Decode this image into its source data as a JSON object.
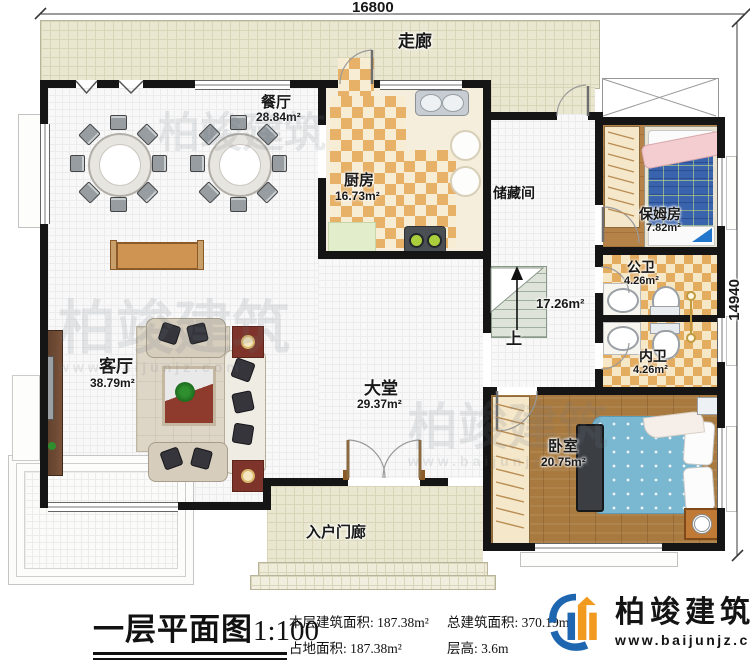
{
  "dimensions": {
    "top": "16800",
    "right": "14940"
  },
  "rooms": {
    "corridor": {
      "name": "走廊"
    },
    "dining": {
      "name": "餐厅",
      "area": "28.84m²"
    },
    "kitchen": {
      "name": "厨房",
      "area": "16.73m²"
    },
    "storage": {
      "name": "储藏间"
    },
    "nanny": {
      "name": "保姆房",
      "area": "7.82m²"
    },
    "public_bath": {
      "name": "公卫",
      "area": "4.26m²"
    },
    "private_bath": {
      "name": "内卫",
      "area": "4.26m²"
    },
    "living": {
      "name": "客厅",
      "area": "38.79m²"
    },
    "hall": {
      "name": "大堂",
      "area": "29.37m²"
    },
    "bedroom": {
      "name": "卧室",
      "area": "20.75m²"
    },
    "porch": {
      "name": "入户门廊"
    },
    "stairwell": {
      "area": "17.26m²",
      "up": "上"
    }
  },
  "title": {
    "text": "一层平面图",
    "scale": "1:100"
  },
  "stats": [
    {
      "label": "本层建筑面积:",
      "value": "187.38m²"
    },
    {
      "label": "总建筑面积:",
      "value": "370.19m²"
    },
    {
      "label": "占地面积:",
      "value": "187.38m²"
    },
    {
      "label": "层高:",
      "value": "3.6m"
    }
  ],
  "logo": {
    "name": "柏竣建筑",
    "url": "www.baijunjz.com"
  },
  "watermark": {
    "text": "柏竣建筑",
    "url": "www.baijunjz.com"
  },
  "colors": {
    "wall": "#151515",
    "kitchen_tile": "#e7b168",
    "wood": "#a97a3f",
    "bed_blue": "#7ab7d0",
    "plaid_blue": "#3a63ae",
    "logo_blue": "#1f66b0",
    "logo_orange": "#f29a1f"
  }
}
